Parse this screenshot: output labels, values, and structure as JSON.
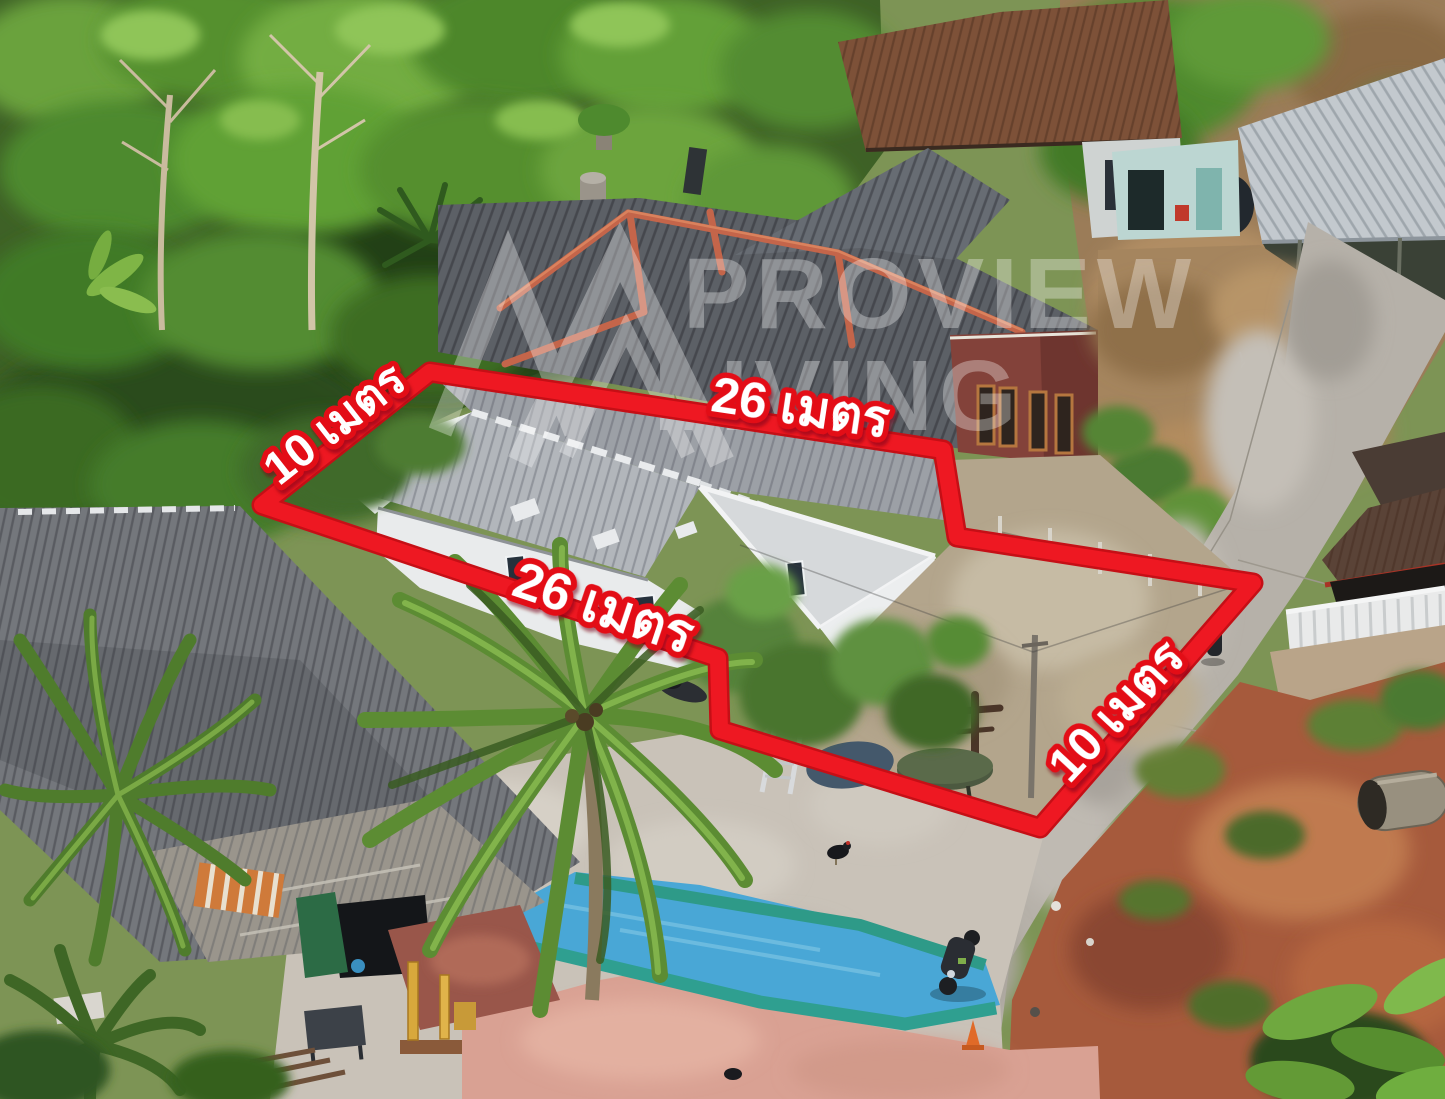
{
  "annotations": {
    "boundary_color": "#ee1822",
    "label_text_color": "#ffffff",
    "labels": [
      {
        "id": "side-left",
        "text": "10 เมตร"
      },
      {
        "id": "side-top",
        "text": "26 เมตร"
      },
      {
        "id": "side-middle",
        "text": "26 เมตร"
      },
      {
        "id": "side-right",
        "text": "10 เมตร"
      }
    ]
  },
  "watermark": {
    "line1": "PROVIEW",
    "line2": "LIVING",
    "logo": "twin-mountain-peaks",
    "color": "#ffffff"
  },
  "scene": {
    "type": "aerial-drone-photo",
    "key_colors": {
      "tarp_blue": "#49a7d6",
      "tarp_teal": "#2f9f90",
      "pink_slab": "#d9a193",
      "road_gray": "#b6b1a9",
      "red_dirt": "#a65a3c",
      "roof_gray": "#74777c",
      "ridge_orange": "#c4654a"
    }
  }
}
